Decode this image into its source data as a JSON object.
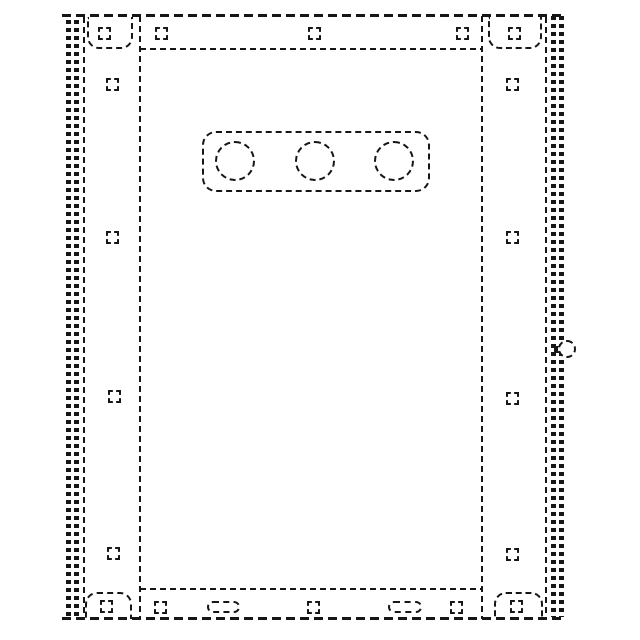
{
  "figure": {
    "kind": "patent-style broken-line technical drawing",
    "subject": "rectangular panel / door front elevation drawn entirely with dashed lines",
    "line_color": "#161616",
    "background_color": "#ffffff",
    "features": {
      "outer_frame": "dashed rectangle with dense double-hatched left and right edge bands",
      "corner_brackets": 4,
      "small_square_fasteners": 18,
      "top_feature_panel_circles": 3,
      "bottom_slot_ovals": 2,
      "right_edge_knob": 1,
      "side_columns": 2,
      "top_rail": 1,
      "bottom_rail": 1
    }
  }
}
